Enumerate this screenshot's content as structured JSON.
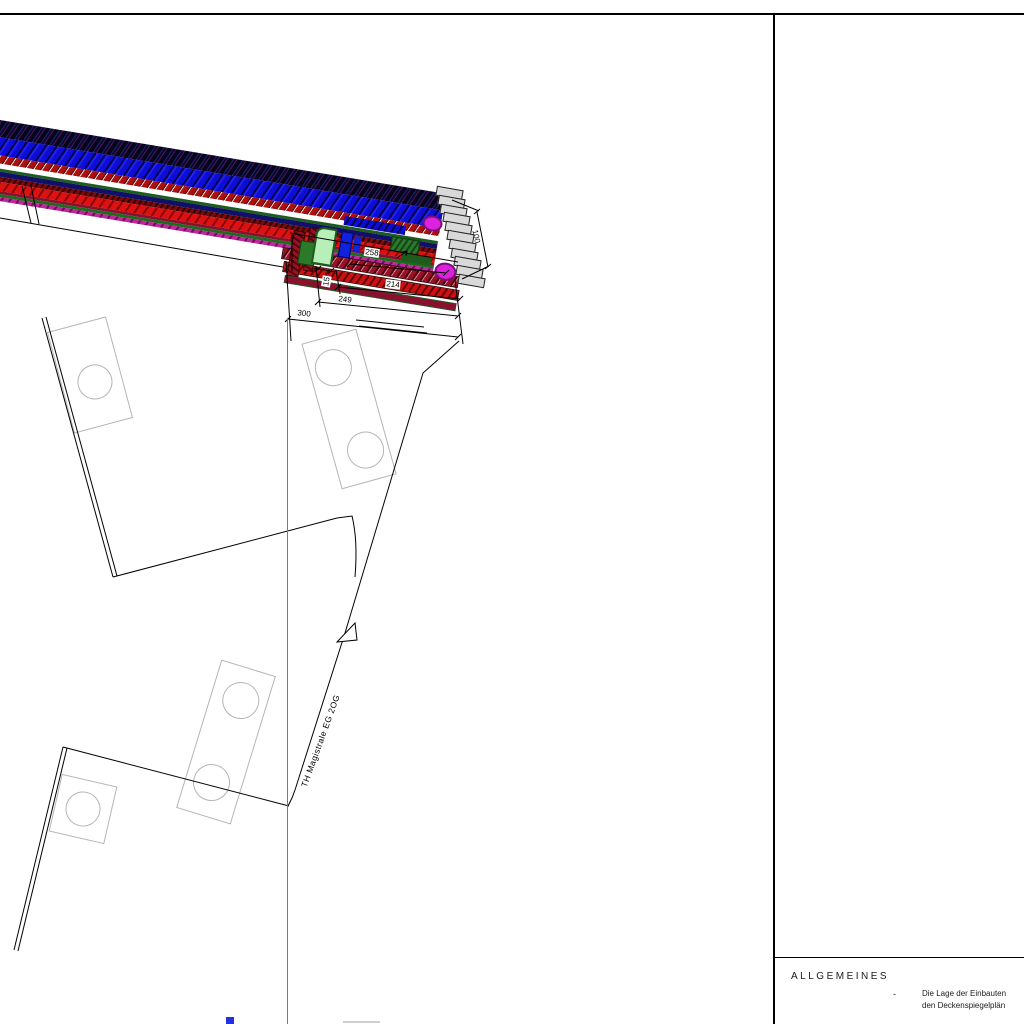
{
  "title_block": {
    "section_title": "ALLGEMEINES",
    "bullet": "-",
    "note_line1": "Die Lage der Einbauten",
    "note_line2": "den Deckenspiegelplän"
  },
  "plan": {
    "corridor_label": "TH Magistrale EG 2OG",
    "dimensions": {
      "overall": "300",
      "chain_249": "249",
      "chain_214": "214",
      "chain_258": "258",
      "gap_15": "15",
      "width_100": "100"
    },
    "stair_steps": 11,
    "colors": {
      "duct_blue": "#1122dd",
      "duct_dark_navy": "#10106a",
      "pipe_red": "#dd1111",
      "pipe_dark_red": "#8b0000",
      "duct_green": "#1d5c1d",
      "duct_pale_green": "#b8eeb8",
      "pipe_magenta": "#dd22dd",
      "grid_cyan": "#00aacc",
      "column_gray": "#b5b5b5"
    }
  }
}
